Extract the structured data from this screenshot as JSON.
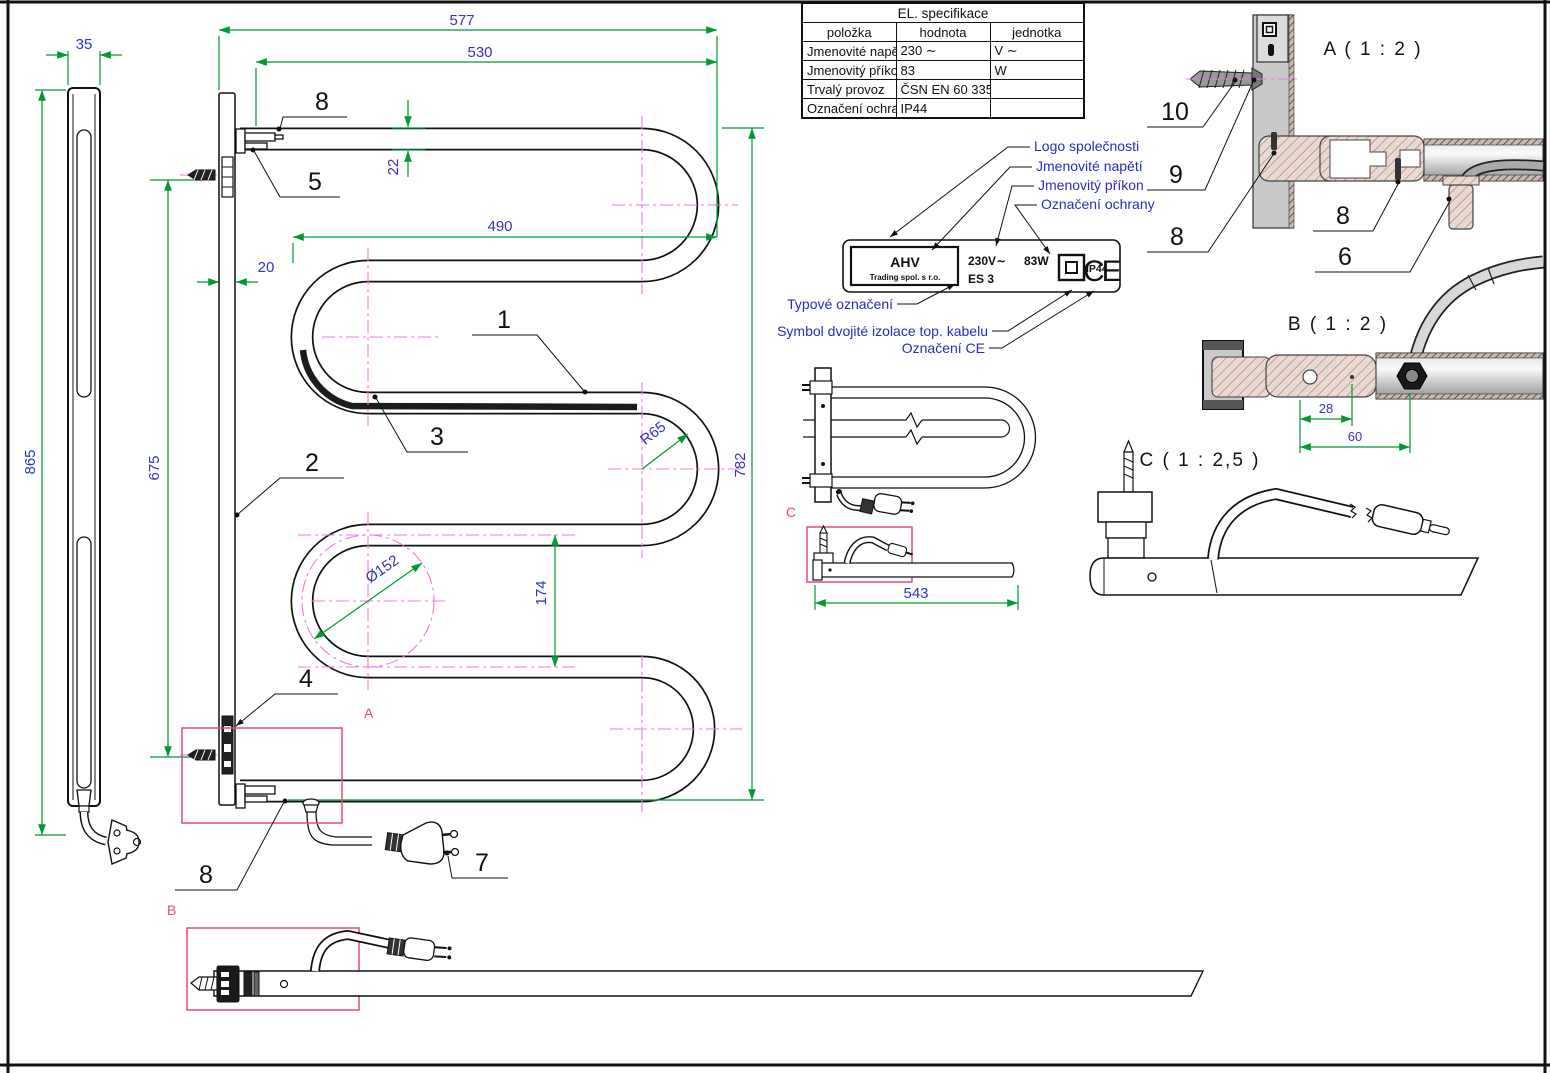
{
  "spec_table": {
    "title": "EL. specifikace",
    "col_item": "položka",
    "col_value": "hodnota",
    "col_unit": "jednotka",
    "rows": [
      {
        "item": "Jmenovité napětí",
        "value": "230 ∼",
        "unit": "V ∼"
      },
      {
        "item": "Jmenovitý příkon",
        "value": "83",
        "unit": "W"
      },
      {
        "item": "Trvalý provoz",
        "value": "ČSN EN 60 335-1",
        "unit": ""
      },
      {
        "item": "Označení ochrany",
        "value": "IP44",
        "unit": ""
      }
    ]
  },
  "callouts": {
    "logo": "Logo společnosti",
    "voltage": "Jmenovité napětí",
    "power": "Jmenovitý příkon",
    "protection": "Označení ochrany",
    "type_label": "Typové označení",
    "insulation": "Symbol dvojité izolace top. kabelu",
    "ce": "Označení CE"
  },
  "nameplate": {
    "brand": "AHV",
    "brand_sub": "Trading spol. s r.o.",
    "voltage": "230V∼",
    "type": "ES 3",
    "power": "83W",
    "ip": "IP44",
    "ce": "CE"
  },
  "views": {
    "a": "A ( 1 : 2 )",
    "b": "B ( 1 : 2 )",
    "c": "C ( 1 : 2,5 )"
  },
  "zones": {
    "a": "A",
    "b": "B",
    "c": "C"
  },
  "dims": {
    "overall_width": "577",
    "tube_width": "530",
    "inner_width": "490",
    "rail_width": "20",
    "tube_dia": "22",
    "bracket_depth": "35",
    "overall_height": "865",
    "mount_pitch": "675",
    "tube_height": "782",
    "loop_pitch": "174",
    "bend_radius": "R65",
    "loop_dia": "Ø152",
    "cable_length": "543",
    "hole_offset": "28",
    "gland_offset": "60"
  },
  "parts": {
    "p1": "1",
    "p2": "2",
    "p3": "3",
    "p4": "4",
    "p5": "5",
    "p6": "6",
    "p7": "7",
    "p8": "8",
    "p9": "9",
    "p10": "10"
  }
}
